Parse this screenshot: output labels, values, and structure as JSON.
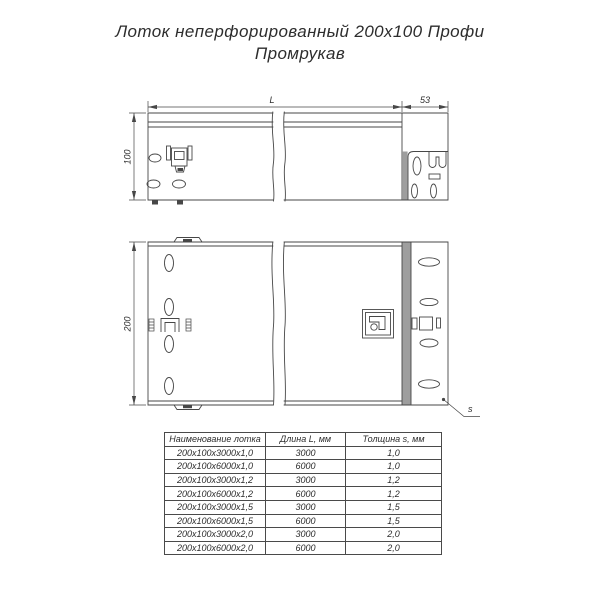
{
  "title": {
    "line1": "Лоток неперфорированный 200х100 Профи",
    "line2": "Промрукав"
  },
  "drawing": {
    "dim_length_label": "L",
    "dim_connector_width": "53",
    "dim_height": "100",
    "dim_width": "200",
    "dim_thickness": "s"
  },
  "table": {
    "headers": [
      "Наименование лотка",
      "Длина L, мм",
      "Толщина s, мм"
    ],
    "rows": [
      [
        "200х100х3000х1,0",
        "3000",
        "1,0"
      ],
      [
        "200х100х6000х1,0",
        "6000",
        "1,0"
      ],
      [
        "200х100х3000х1,2",
        "3000",
        "1,2"
      ],
      [
        "200х100х6000х1,2",
        "6000",
        "1,2"
      ],
      [
        "200х100х3000х1,5",
        "3000",
        "1,5"
      ],
      [
        "200х100х6000х1,5",
        "6000",
        "1,5"
      ],
      [
        "200х100х3000х2,0",
        "3000",
        "2,0"
      ],
      [
        "200х100х6000х2,0",
        "6000",
        "2,0"
      ]
    ]
  },
  "colors": {
    "line": "#474747",
    "text": "#2d2d2d",
    "gray_band": "#9e9e9e",
    "background": "#ffffff"
  }
}
